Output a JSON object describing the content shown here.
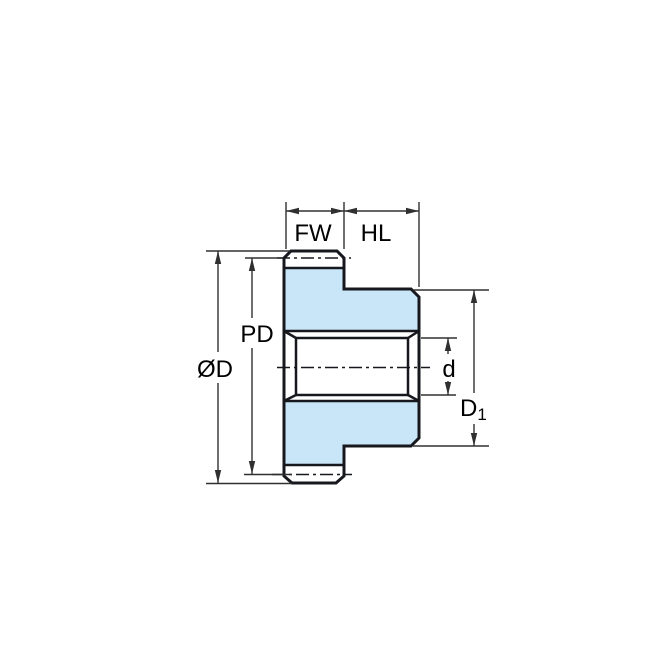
{
  "diagram": {
    "kind": "gear-cross-section-dimension-drawing",
    "colors": {
      "part_fill": "#c9e6f8",
      "part_line": "#16181d",
      "dim_line": "#303030",
      "label_text": "#000000",
      "label_bg": "#ffffff"
    },
    "labels": {
      "fw": "FW",
      "hl": "HL",
      "pd": "PD",
      "od": "ØD",
      "d": "d",
      "d1_base": "D",
      "d1_sub": "1"
    }
  }
}
